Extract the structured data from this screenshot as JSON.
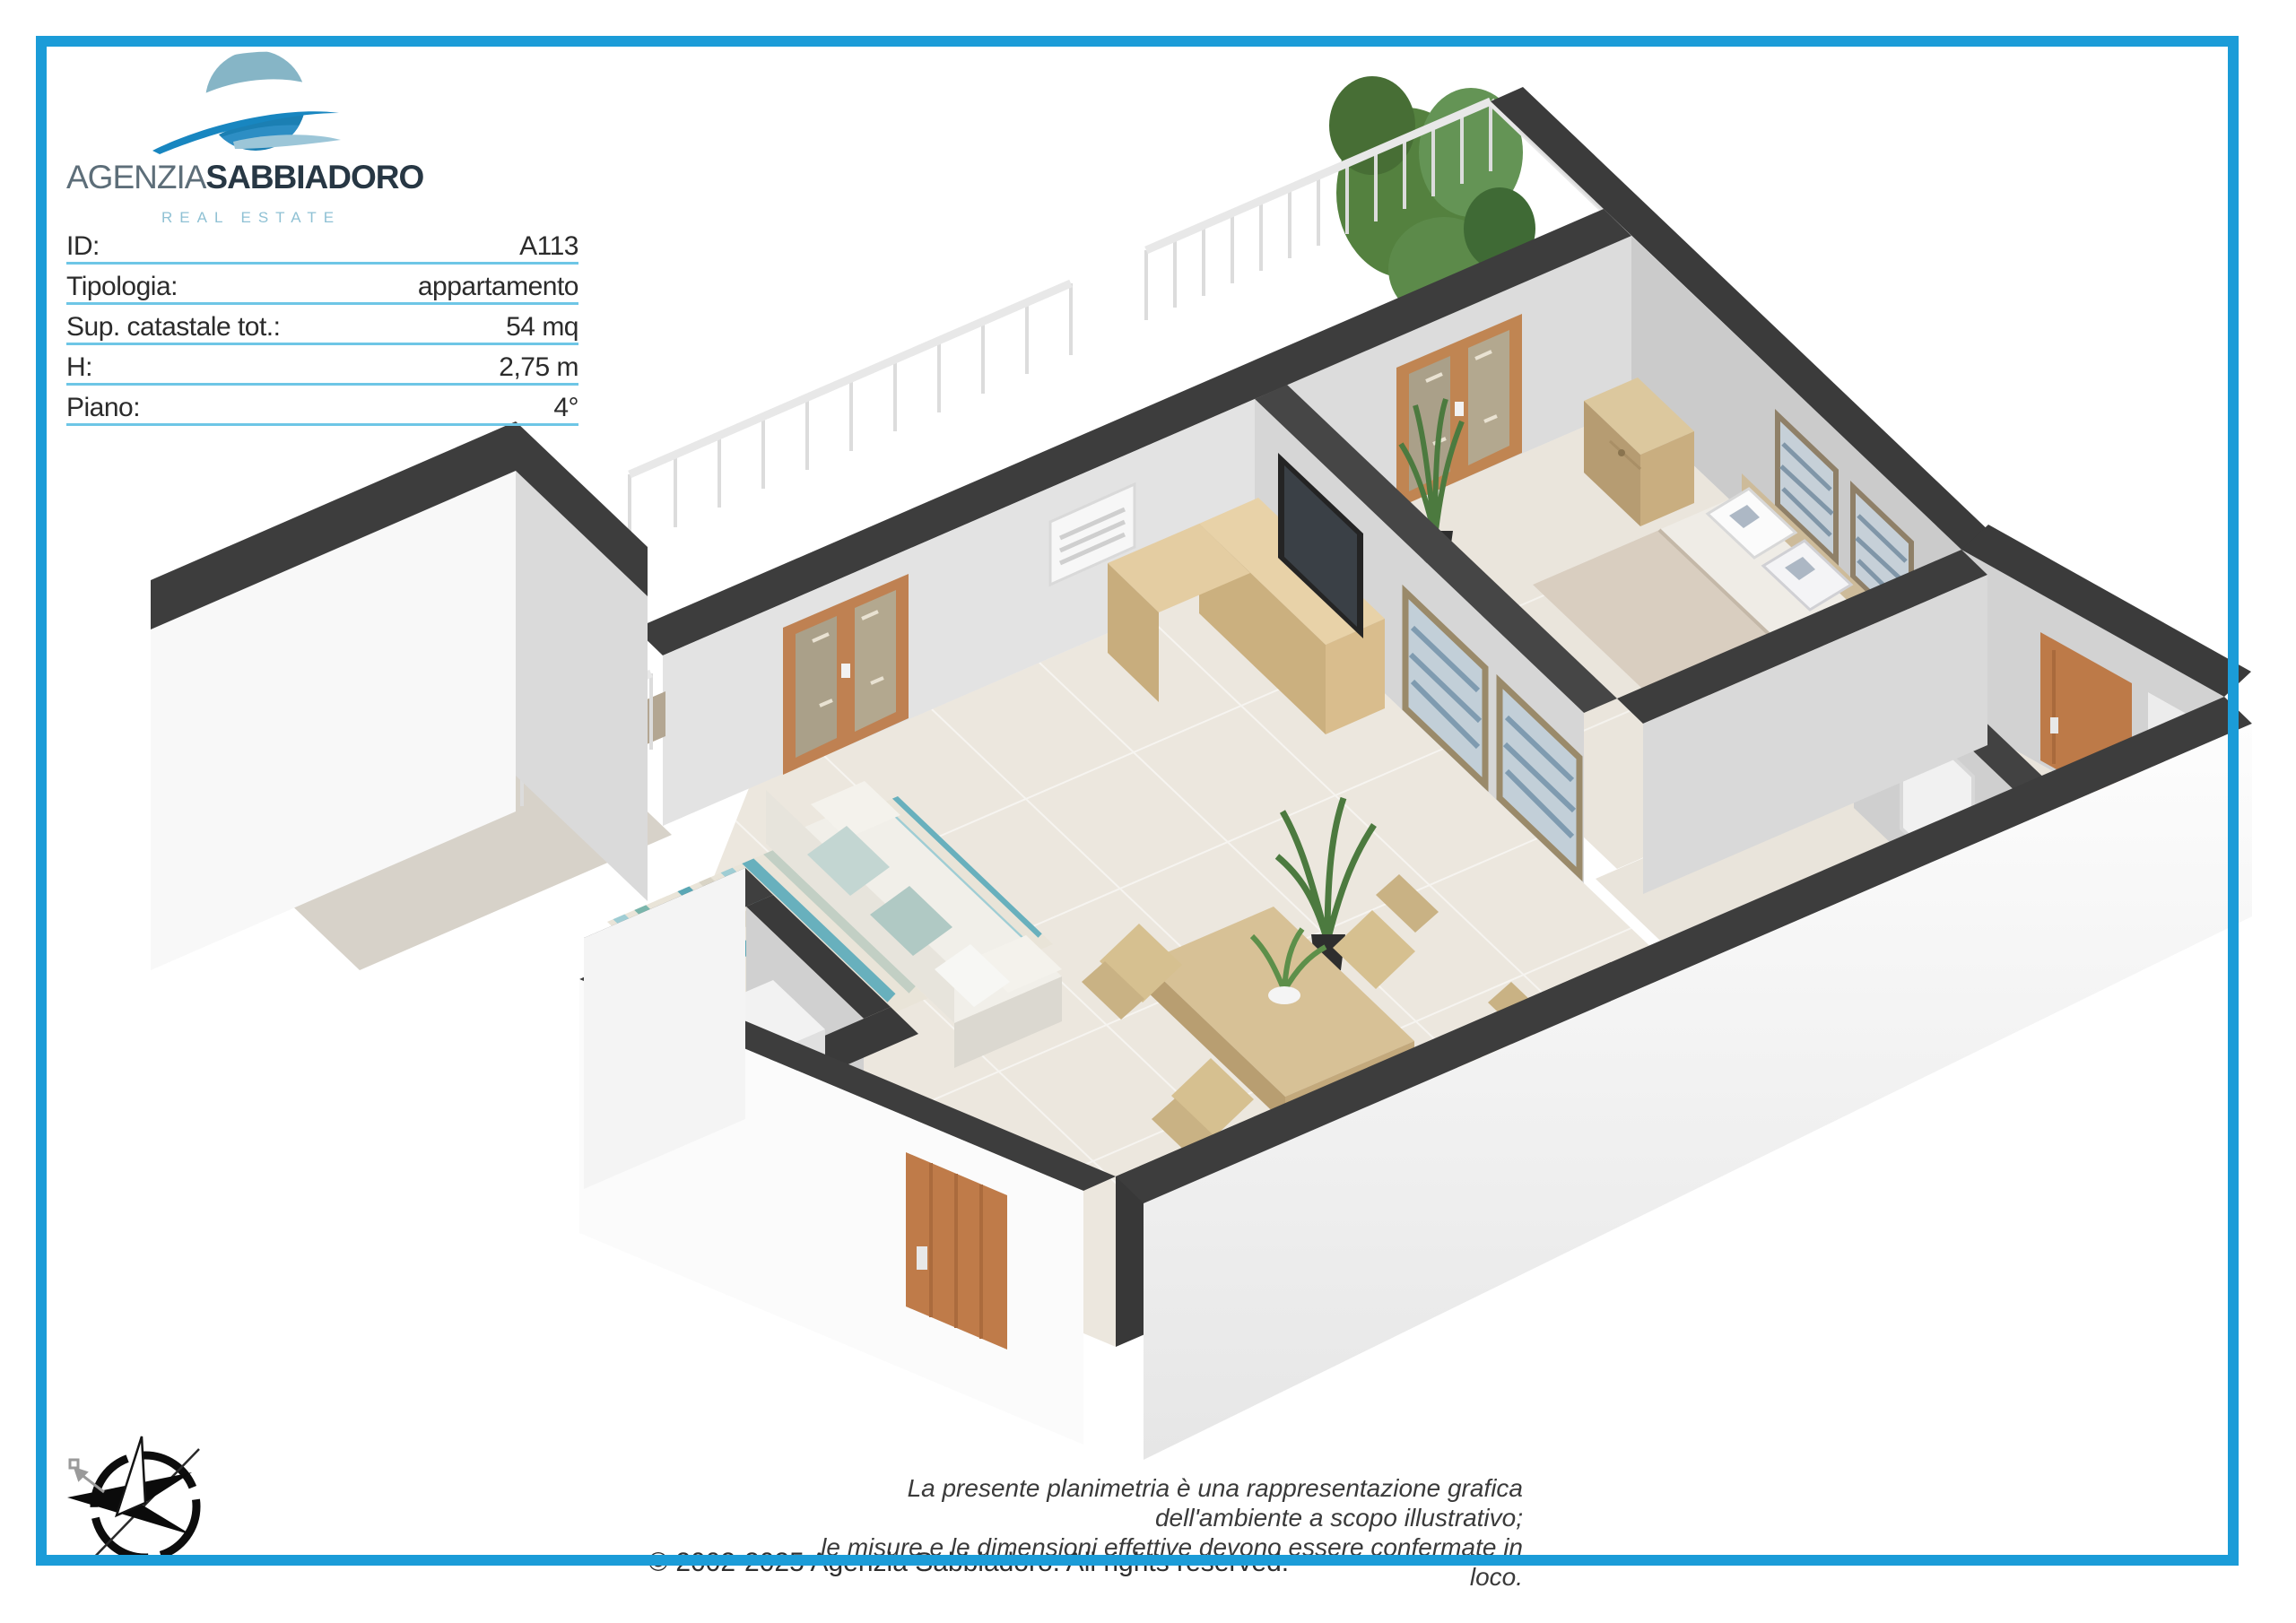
{
  "logo": {
    "brand_regular": "AGENZIA",
    "brand_bold": "SABBIADORO",
    "tagline": "REAL ESTATE",
    "colors": {
      "wave_light": "#b5cdd5",
      "wave_mid": "#86b5c6",
      "wave_deep": "#1b7fb3",
      "wave_bottom": "#2d8ec4"
    }
  },
  "property": {
    "rows": [
      {
        "label": "ID:",
        "value": "A113"
      },
      {
        "label": "Tipologia:",
        "value": "appartamento"
      },
      {
        "label": "Sup. catastale tot.:",
        "value": "54 mq"
      },
      {
        "label": "H:",
        "value": "2,75 m"
      },
      {
        "label": "Piano:",
        "value": "4°"
      }
    ]
  },
  "floorplan": {
    "type": "3d-isometric-floorplan",
    "elements": [
      "balcony-railing",
      "tree",
      "bed",
      "nightstand",
      "wall-pictures",
      "air-conditioner",
      "tv",
      "tv-cabinet",
      "french-doors",
      "striped-rug",
      "sofa",
      "dining-table",
      "dining-chairs",
      "kitchen-cabinets",
      "entrance-door",
      "interior-doors",
      "plants"
    ],
    "palette": {
      "wall_top": "#3d3d3d",
      "wall_outer": "#f8f8f8",
      "wall_inner": "#d4d4d4",
      "floor": "#ece7de",
      "wood": "#c07c4a",
      "rug_teal": "#68b0bd"
    }
  },
  "disclaimer": {
    "line1": "La presente planimetria è una rappresentazione grafica dell'ambiente a scopo illustrativo;",
    "line2": "le misure e le dimensioni effettive devono essere confermate in loco."
  },
  "copyright": "© 2002-2025 Agenzia Sabbiadoro. All rights reserved.",
  "page": {
    "border_color": "#1b9cd8",
    "underline_color": "#6ec6e6"
  }
}
